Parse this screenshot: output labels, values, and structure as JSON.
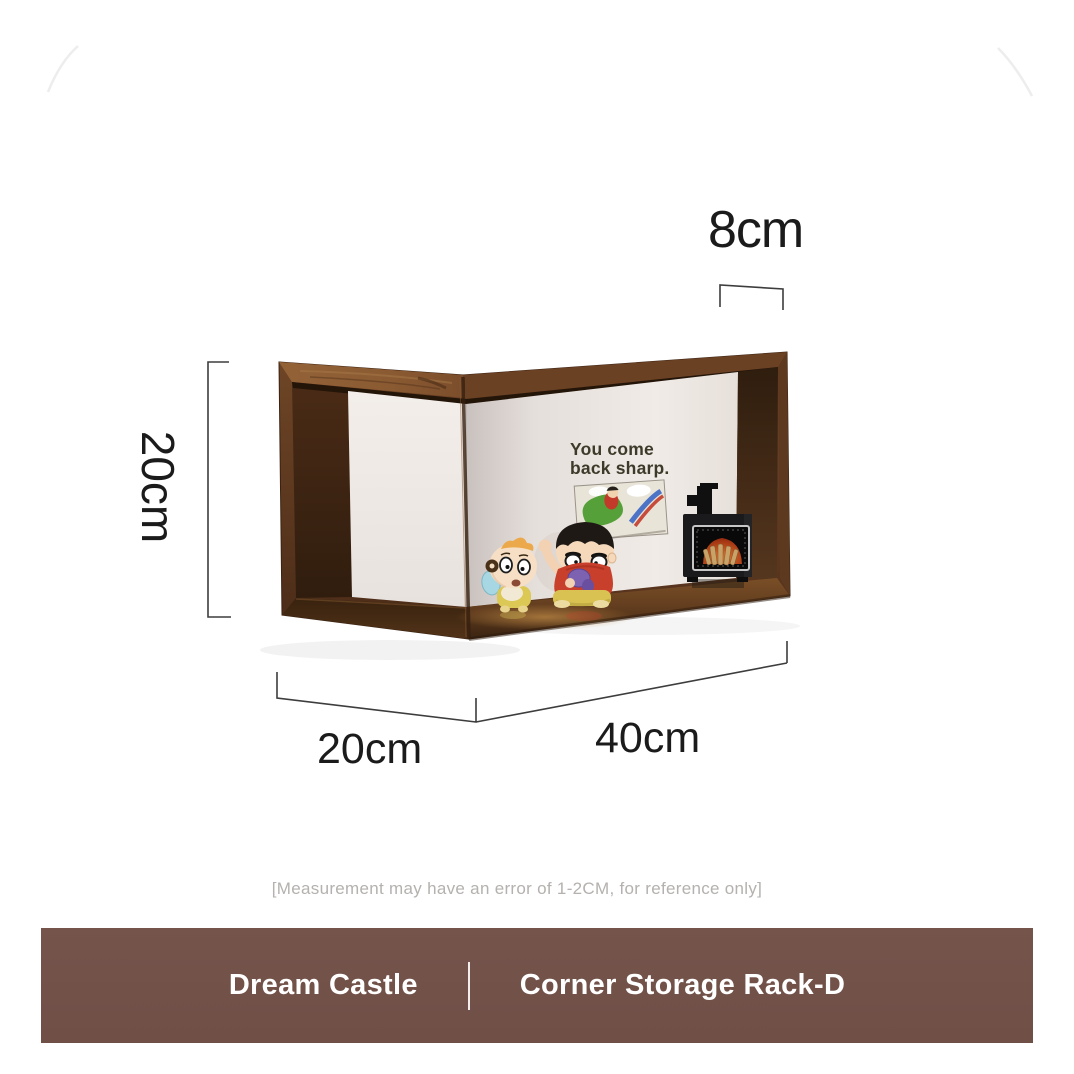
{
  "dimensions": {
    "top_depth_label": "8cm",
    "height_label": "20cm",
    "left_depth_label": "20cm",
    "width_label": "40cm"
  },
  "scene": {
    "wall_text_line1": "You come",
    "wall_text_line2": "back sharp.",
    "objects": [
      "corner storage rack",
      "cartoon painting",
      "miniature fireplace stove",
      "shinchan figurine",
      "himawari figurine"
    ]
  },
  "footer": {
    "disclaimer": "[Measurement may have an error of 1-2CM, for reference only]",
    "banner": {
      "brand": "Dream Castle",
      "product_name": "Corner Storage Rack-D",
      "background_color": "#72524a",
      "text_color": "#ffffff"
    }
  },
  "palette": {
    "wood_dark": "#4a2b17",
    "wood_mid": "#6b4124",
    "wood_light": "#936237",
    "wall_white": "#efe9e5",
    "floor_highlight": "#c08b46",
    "dimension_line": "#3d3d3d",
    "label_text": "#1b1b1b",
    "disclaimer_text": "#b4b1ae"
  }
}
